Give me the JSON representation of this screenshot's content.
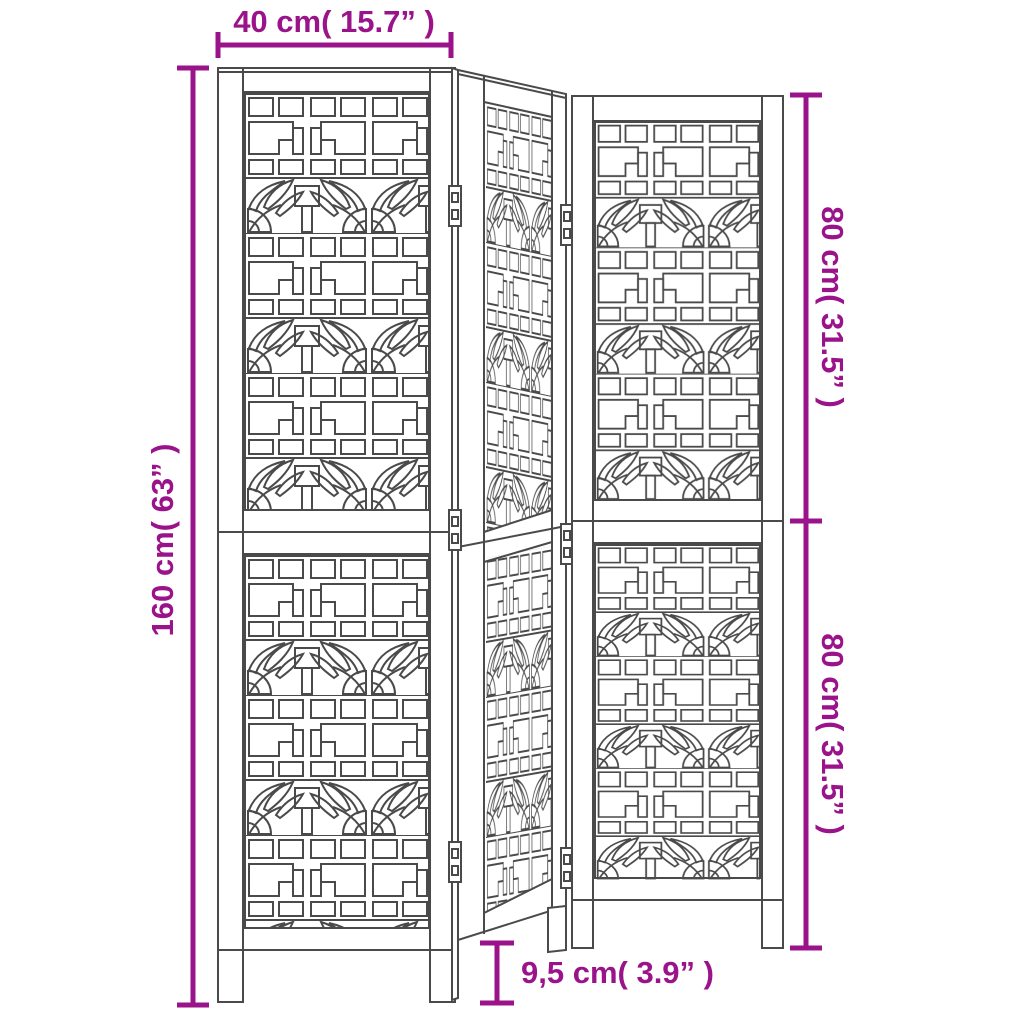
{
  "diagram": {
    "subject": "3-panel folding room divider with decorative fretwork",
    "view": "dimension drawing",
    "labels": {
      "panel_width": "40 cm( 15.7”  )",
      "total_height": "160 cm( 63”  )",
      "section_height_top": "80 cm( 31.5”  )",
      "section_height_bottom": "80 cm( 31.5”  )",
      "leg_height": "9,5 cm( 3.9”  )"
    }
  },
  "colors": {
    "dimension_accent": "#9A138A",
    "drawing_line": "#4A4A4A",
    "background": "#FFFFFF"
  }
}
